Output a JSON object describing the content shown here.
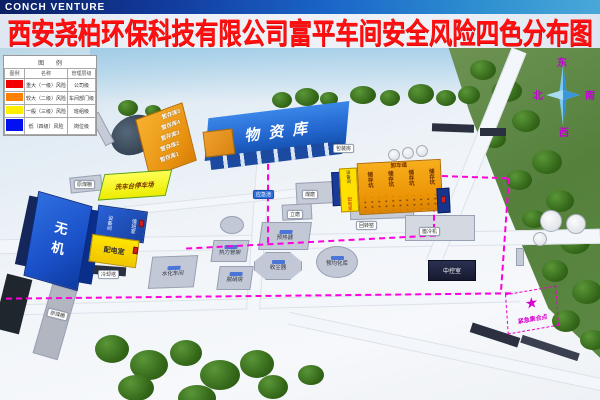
{
  "logo": "CONCH VENTURE",
  "title": "西安尧柏环保科技有限公司富平车间安全风险四色分布图",
  "legend": {
    "title": "图  例",
    "headers": {
      "swatch": "图例",
      "name": "名称",
      "level": "管理层级"
    },
    "rows": [
      {
        "color": "#f20000",
        "name": "重大（一级）风险",
        "level": "公司级"
      },
      {
        "color": "#ff7f00",
        "name": "较大（二级）风险",
        "level": "车间部门级"
      },
      {
        "color": "#fff000",
        "name": "一般（三级）风险",
        "level": "班组级"
      },
      {
        "color": "#0010f0",
        "name": "低（四级）风险",
        "level": "岗位级"
      }
    ]
  },
  "compass": {
    "east": "东",
    "south": "南",
    "west": "西",
    "north": "北"
  },
  "colors": {
    "route": "#ff00dc",
    "title_red": "#ff0f0f"
  },
  "map": {
    "wuziku": "物资库",
    "baozhuangfang": "包装房",
    "zancunku": [
      "暂存库5",
      "暂存库4",
      "暂存库3",
      "暂存库2",
      "暂存库1"
    ],
    "xichetai": "洗车台停车场",
    "yuanmeipeng_top": "原煤棚",
    "yuanmeipeng_bottom": "原煤棚",
    "wuji": "无机",
    "shebeijian": "设备间",
    "zhibanshi": "值班室",
    "peidianshi": "配电室",
    "lengqueta": "冷却塔",
    "meimo": "煤磨",
    "limo": "立磨",
    "yingjichi": "应急池",
    "shuihua": "水化车间",
    "reli": "热力管架",
    "yureqi": "预热器",
    "shouchen": "收尘器",
    "tuoxiao": "脱硝房",
    "yujunhua": "预均化库",
    "xiechedao": "卸车道",
    "chukeng": [
      "储存坑",
      "储存坑",
      "储存坑",
      "储存坑"
    ],
    "ck_shebeijian": "设备间",
    "ck_peidianshi": "配电室",
    "huizhuanyao": "回转窑",
    "bilengji": "篦冷机",
    "zhongkong": "中控室",
    "assembly_star": "★",
    "assembly_label": "紧急集合点"
  }
}
